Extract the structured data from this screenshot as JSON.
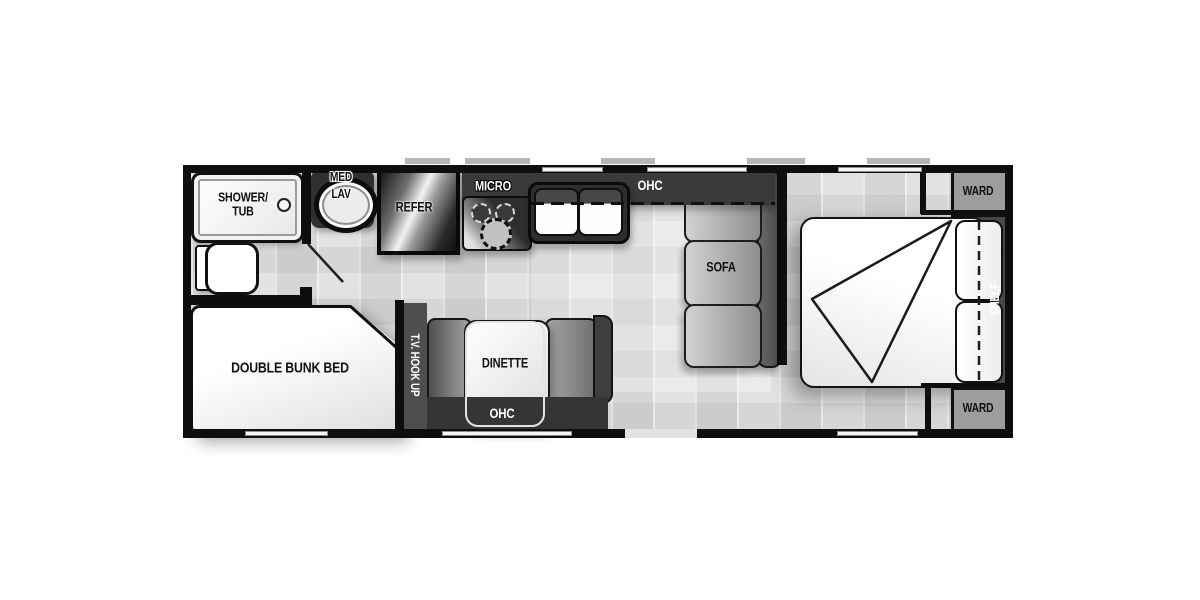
{
  "colors": {
    "wall": "#0e0e0e",
    "cabinet_dark": "#3a3a3a",
    "floor": "#e2e2e2",
    "ward_gray": "#9d9d9d",
    "shelf_gray": "#484848",
    "tv_band_gray": "#4e4e4e",
    "sofa_back_gray": "#5f5f5f",
    "furniture_white": "#fbfbfb",
    "outline_black": "#101010"
  },
  "bathroom": {
    "shower_line1": "SHOWER/",
    "shower_line2": "TUB",
    "med_line1": "MED",
    "med_line2": "LAV"
  },
  "kitchen": {
    "refer": "REFER",
    "micro": "MICRO",
    "ohc": "OHC"
  },
  "living": {
    "sofa": "SOFA"
  },
  "dinette": {
    "label": "DINETTE",
    "ohc": "OHC",
    "tv_hookup": "T.V. HOOK UP"
  },
  "bedroom": {
    "ward_top": "WARD",
    "ward_bottom": "WARD",
    "shelf": "SHELF"
  },
  "bunk": {
    "label": "DOUBLE BUNK BED"
  }
}
